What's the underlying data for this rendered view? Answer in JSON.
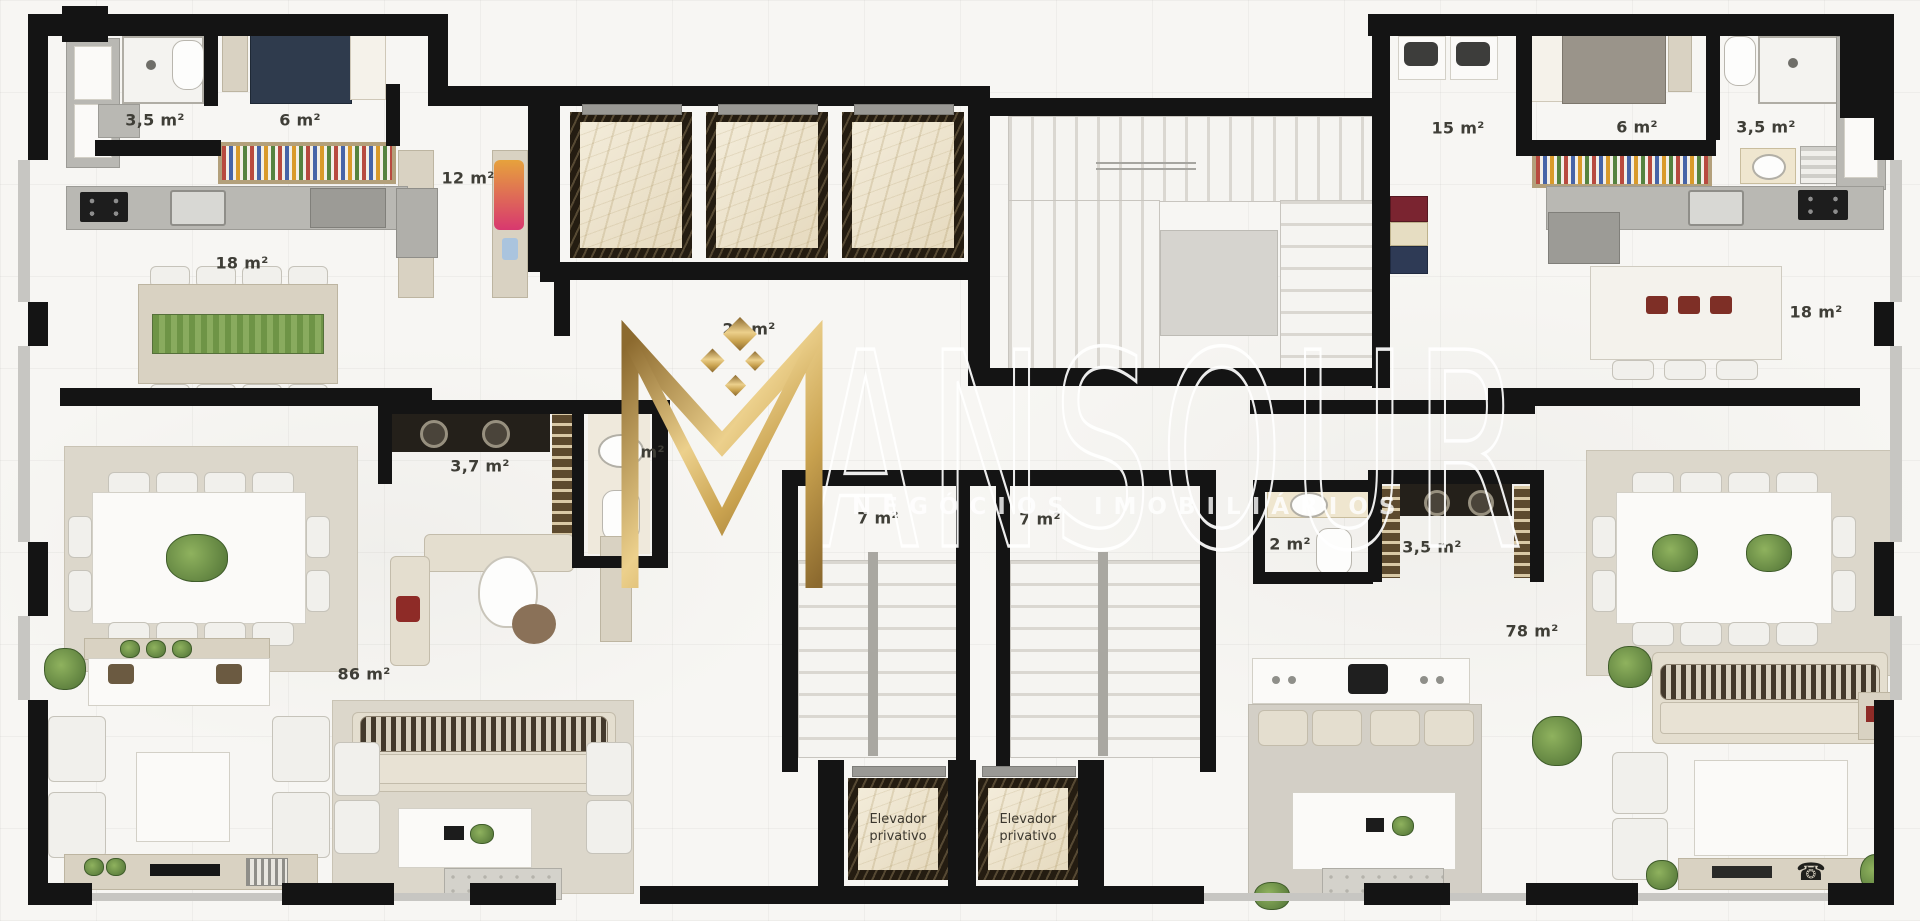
{
  "watermark": {
    "monogram": "M",
    "wordmark_rest": "ANSOUR",
    "brand_full": "MANSOUR",
    "subtitle": "NEGÓCIOS IMOBILIÁRIOS",
    "gold": "#c9a45a"
  },
  "room_labels": {
    "left_suite_bath": "3,5 m²",
    "left_bedroom": "6 m²",
    "left_closet": "12 m²",
    "left_kitchen": "18 m²",
    "hall": "21 m²",
    "left_bathroom": "3,7 m²",
    "left_lavabo": "2 m²",
    "left_stairs": "7 m²",
    "right_stairs": "7 m²",
    "left_living": "86 m²",
    "right_service": "15 m²",
    "right_bedroom": "6 m²",
    "right_suite_bath": "3,5 m²",
    "right_kitchen": "18 m²",
    "right_lavabo": "2 m²",
    "right_bathroom": "3,5 m²",
    "right_living": "78 m²",
    "left_private_elevator": "Elevador privativo",
    "right_private_elevator": "Elevador privativo"
  },
  "icons": {
    "phone": "☎"
  },
  "palette": {
    "wall": "#141414",
    "floor": "#f7f6f3",
    "marble": "#ece2cc",
    "accent_green": "#6f9e4f",
    "bed_navy": "#2f3b4d",
    "accent_red": "#8e2b27"
  }
}
